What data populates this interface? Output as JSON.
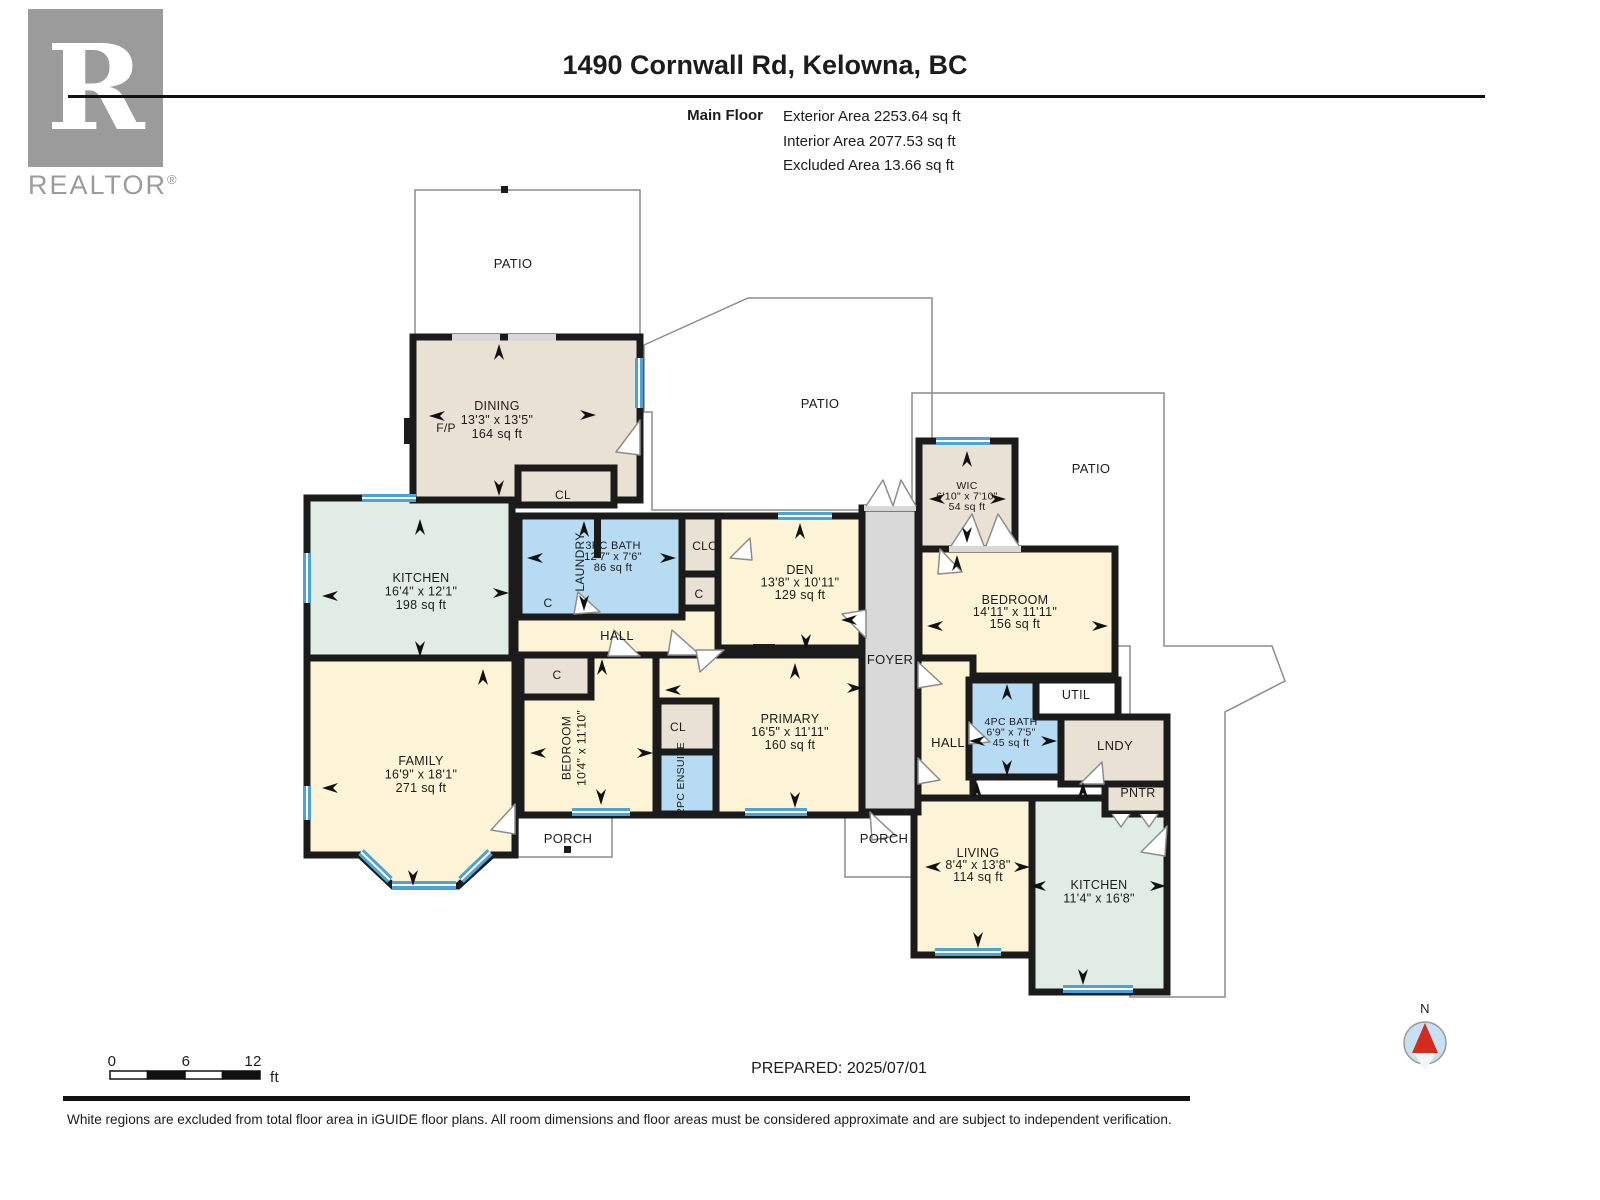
{
  "logo": {
    "letter": "R",
    "wordmark": "REALTOR",
    "registered": "®"
  },
  "header": {
    "title": "1490 Cornwall Rd, Kelowna, BC",
    "floor": "Main Floor",
    "areas": [
      "Exterior Area 2253.64 sq ft",
      "Interior Area 2077.53 sq ft",
      "Excluded Area 13.66 sq ft"
    ]
  },
  "plan": {
    "labels": [
      {
        "id": "patio-top",
        "lines": [
          "PATIO"
        ]
      },
      {
        "id": "dining",
        "lines": [
          "DINING",
          "13'3\" x 13'5\"",
          "164 sq ft"
        ]
      },
      {
        "id": "fp",
        "lines": [
          "F/P"
        ]
      },
      {
        "id": "cl-dining",
        "lines": [
          "CL"
        ]
      },
      {
        "id": "patio-mid",
        "lines": [
          "PATIO"
        ]
      },
      {
        "id": "kitchen-left",
        "lines": [
          "KITCHEN",
          "16'4\" x 12'1\"",
          "198 sq ft"
        ]
      },
      {
        "id": "family",
        "lines": [
          "FAMILY",
          "16'9\" x 18'1\"",
          "271 sq ft"
        ]
      },
      {
        "id": "laundry",
        "lines": [
          "LAUNDRY"
        ]
      },
      {
        "id": "bath3",
        "lines": [
          "3PC BATH",
          "12'7\" x 7'6\"",
          "86 sq ft"
        ]
      },
      {
        "id": "clo",
        "lines": [
          "CLO"
        ]
      },
      {
        "id": "c-clo",
        "lines": [
          "C"
        ]
      },
      {
        "id": "c-hall",
        "lines": [
          "C"
        ]
      },
      {
        "id": "hall-main",
        "lines": [
          "HALL"
        ]
      },
      {
        "id": "den",
        "lines": [
          "DEN",
          "13'8\" x 10'11\"",
          "129 sq ft"
        ]
      },
      {
        "id": "foyer",
        "lines": [
          "FOYER"
        ]
      },
      {
        "id": "bedroom-mid",
        "lines": [
          "BEDROOM",
          "10'4\" x 11'10\""
        ]
      },
      {
        "id": "c-bedroom",
        "lines": [
          "C"
        ]
      },
      {
        "id": "cl-primary",
        "lines": [
          "CL"
        ]
      },
      {
        "id": "ensuite",
        "lines": [
          "2PC ENSUITE"
        ]
      },
      {
        "id": "primary",
        "lines": [
          "PRIMARY",
          "16'5\" x 11'11\"",
          "160 sq ft"
        ]
      },
      {
        "id": "porch-left",
        "lines": [
          "PORCH"
        ]
      },
      {
        "id": "porch-right",
        "lines": [
          "PORCH"
        ]
      },
      {
        "id": "wic",
        "lines": [
          "WIC",
          "6'10\" x 7'10\"",
          "54 sq ft"
        ]
      },
      {
        "id": "patio-right",
        "lines": [
          "PATIO"
        ]
      },
      {
        "id": "bedroom-right",
        "lines": [
          "BEDROOM",
          "14'11\" x 11'11\"",
          "156 sq ft"
        ]
      },
      {
        "id": "util",
        "lines": [
          "UTIL"
        ]
      },
      {
        "id": "bath4",
        "lines": [
          "4PC BATH",
          "6'9\" x 7'5\"",
          "45 sq ft"
        ]
      },
      {
        "id": "hall-right",
        "lines": [
          "HALL"
        ]
      },
      {
        "id": "lndy",
        "lines": [
          "LNDY"
        ]
      },
      {
        "id": "pntr",
        "lines": [
          "PNTR"
        ]
      },
      {
        "id": "living",
        "lines": [
          "LIVING",
          "8'4\" x 13'8\"",
          "114 sq ft"
        ]
      },
      {
        "id": "kitchen-right",
        "lines": [
          "KITCHEN",
          "11'4\" x 16'8\""
        ]
      },
      {
        "id": "scale-0",
        "lines": [
          "0"
        ]
      },
      {
        "id": "scale-6",
        "lines": [
          "6"
        ]
      },
      {
        "id": "scale-12",
        "lines": [
          "12"
        ]
      },
      {
        "id": "scale-unit",
        "lines": [
          "ft"
        ]
      },
      {
        "id": "compass-n",
        "lines": [
          "N"
        ]
      }
    ]
  },
  "prepared": "PREPARED: 2025/07/01",
  "footer": "White regions are excluded from total floor area in iGUIDE floor plans. All room dimensions and floor areas must be considered approximate and are subject to independent verification.",
  "colors": {
    "wall": "#1b1b1b",
    "room_cream": "#fdf3d6",
    "room_mint": "#e1ece4",
    "room_tan": "#e9e1d4",
    "room_blue": "#b7dbf3",
    "foyer_grey": "#d9d9d9",
    "window_blue": "#4da3d8",
    "compass_red": "#d42b1e",
    "compass_fill": "#c9e0f4"
  }
}
